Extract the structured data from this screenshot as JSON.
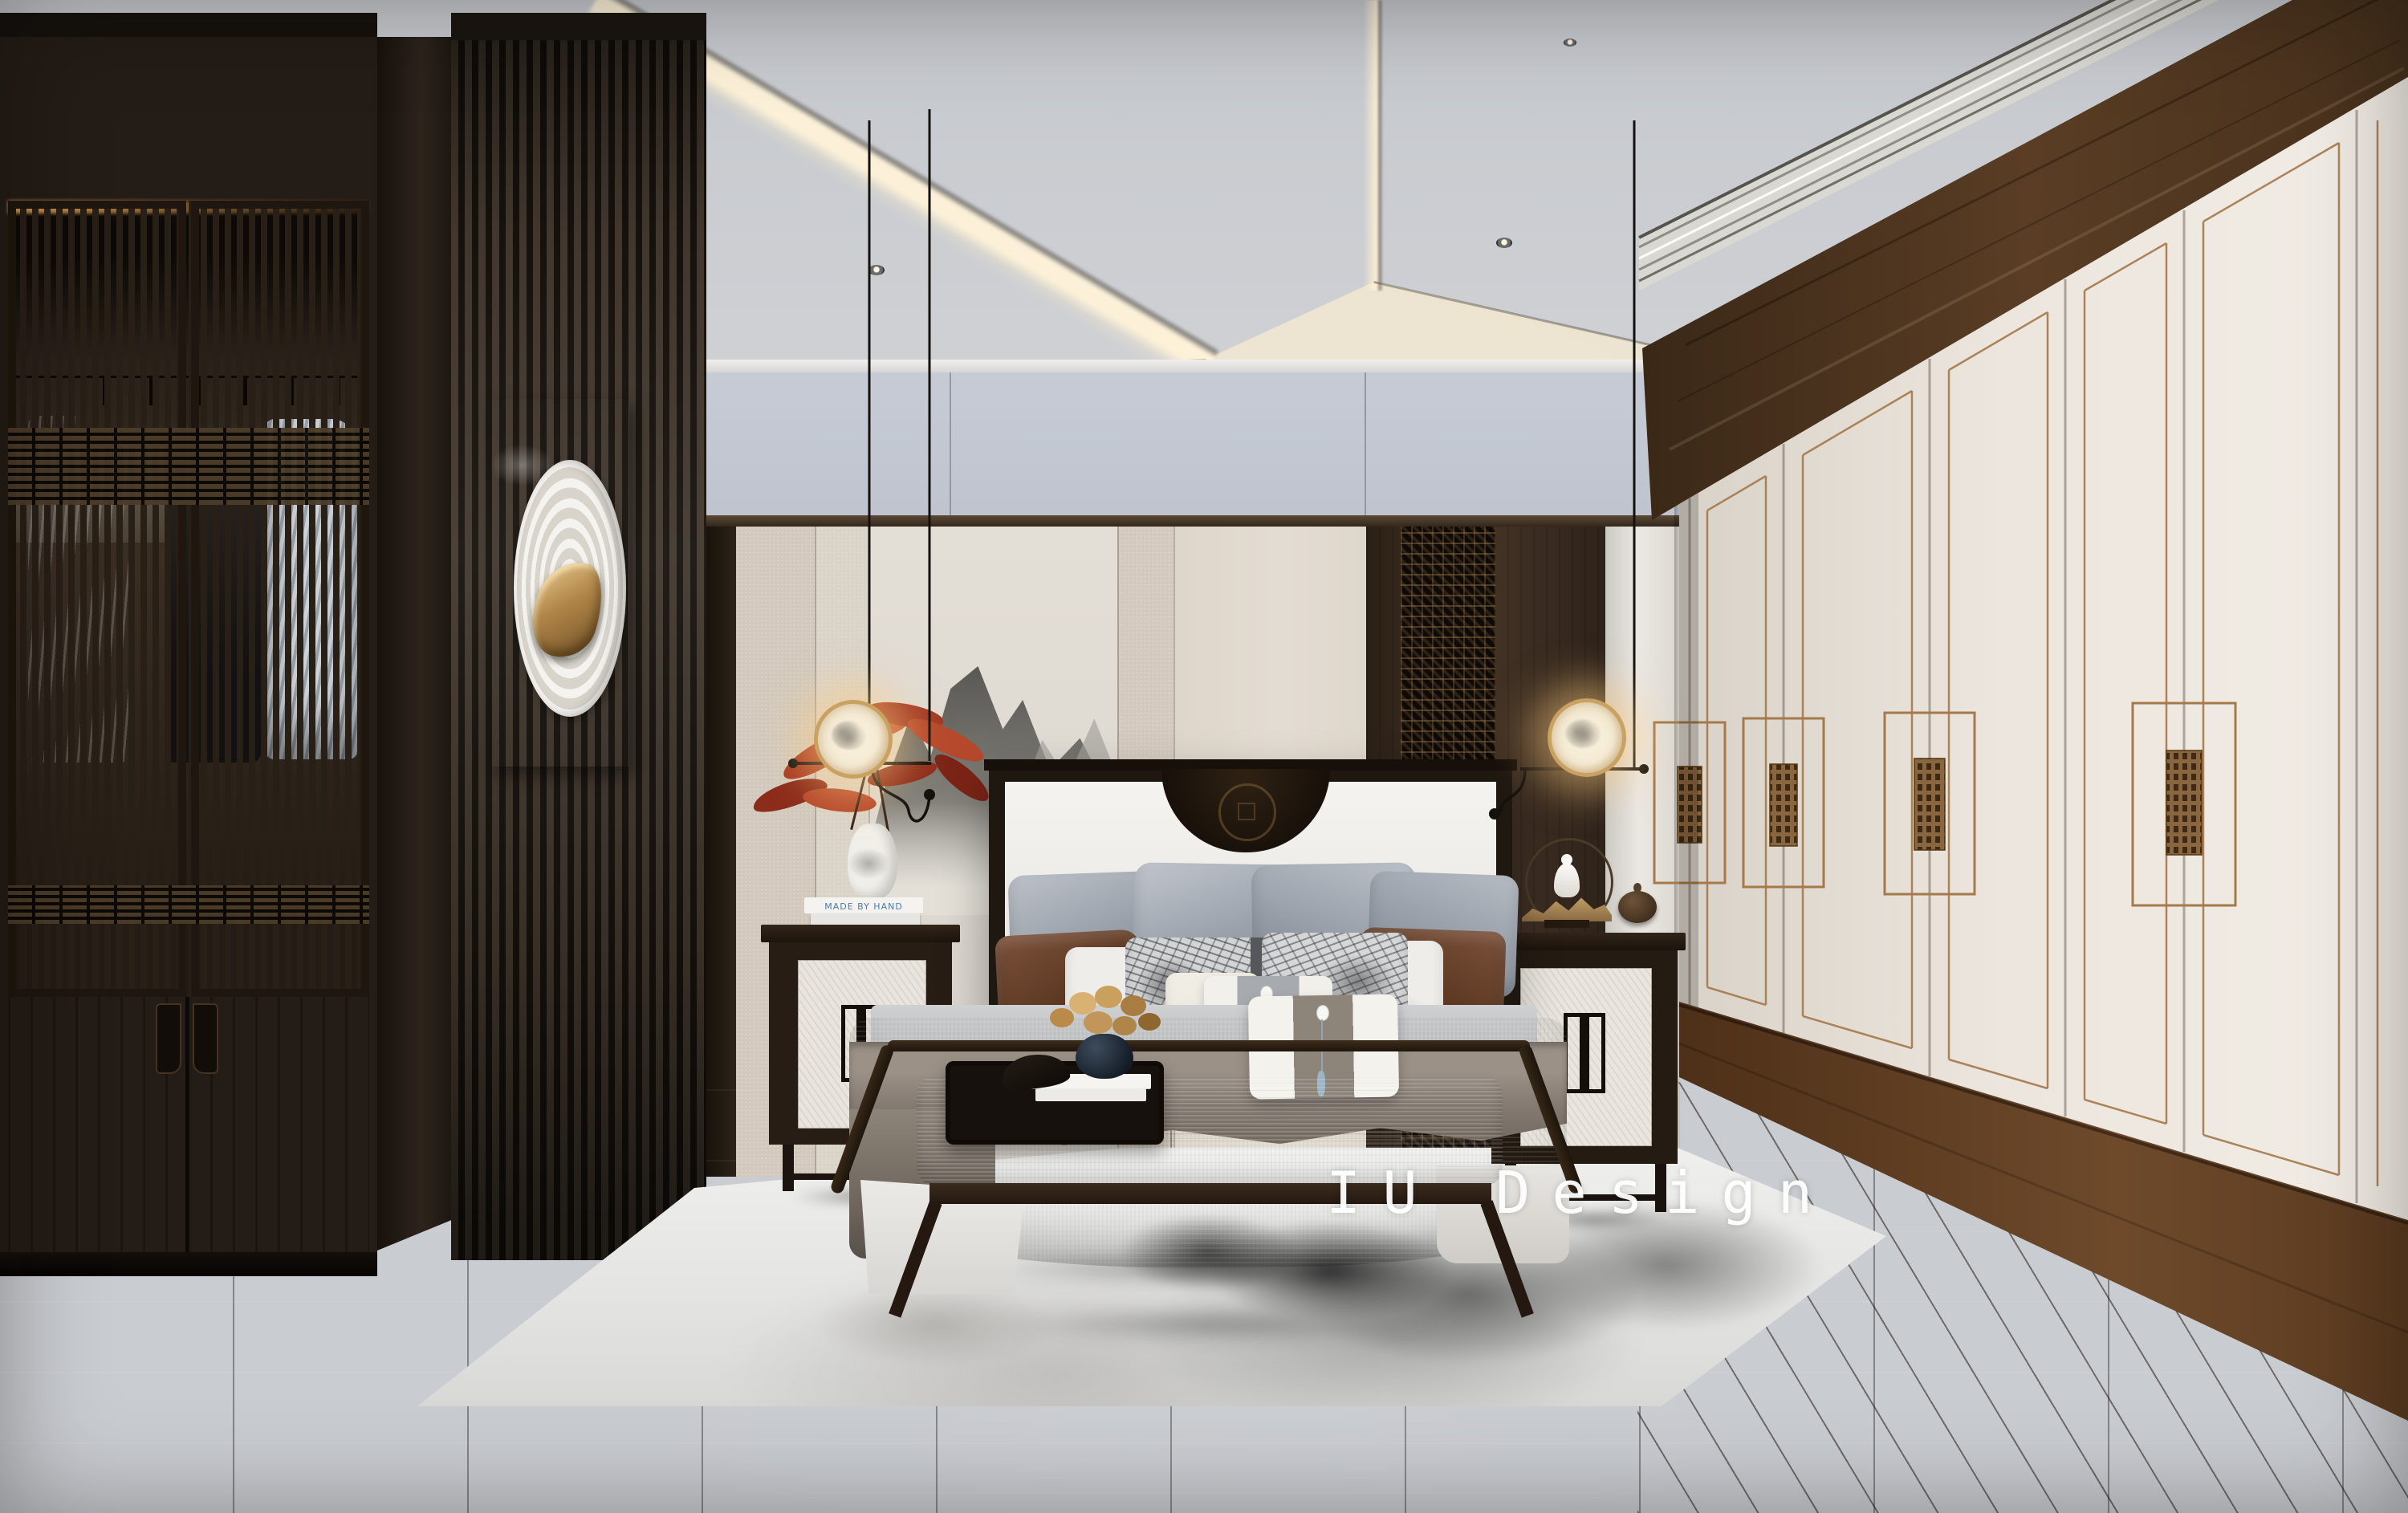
{
  "watermark": {
    "text": "IU Design"
  },
  "objects": {
    "nightstand_left": {
      "book_spine_text": "MADE BY HAND"
    }
  },
  "palette": {
    "ceiling-gray": "#c9ccd1",
    "ceiling-warm": "#f4ecdc",
    "wall-upper": "#c6cbd5",
    "wall-beige": "#d5ccbf",
    "wall-cream": "#e2dcd2",
    "walnut": "#3a2d22",
    "walnut-deep": "#1d1510",
    "ebony": "#181210",
    "door-cream": "#eae4dc",
    "bronze": "#a5794b",
    "plinth-wood": "#5e3e28",
    "floor-dark": "#322a24",
    "floor-right": "#473829",
    "rug": "#ebebe9",
    "duvet": "#c3c5c7",
    "throw": "#8a8076",
    "pillow-gray": "#a7adb5",
    "pillow-brown": "#5e3b28",
    "lamp-glow": "#ffd9a3",
    "lamp-gold": "#c9a261",
    "art-stone": "#b4a896",
    "accent-red": "#a63a22"
  }
}
